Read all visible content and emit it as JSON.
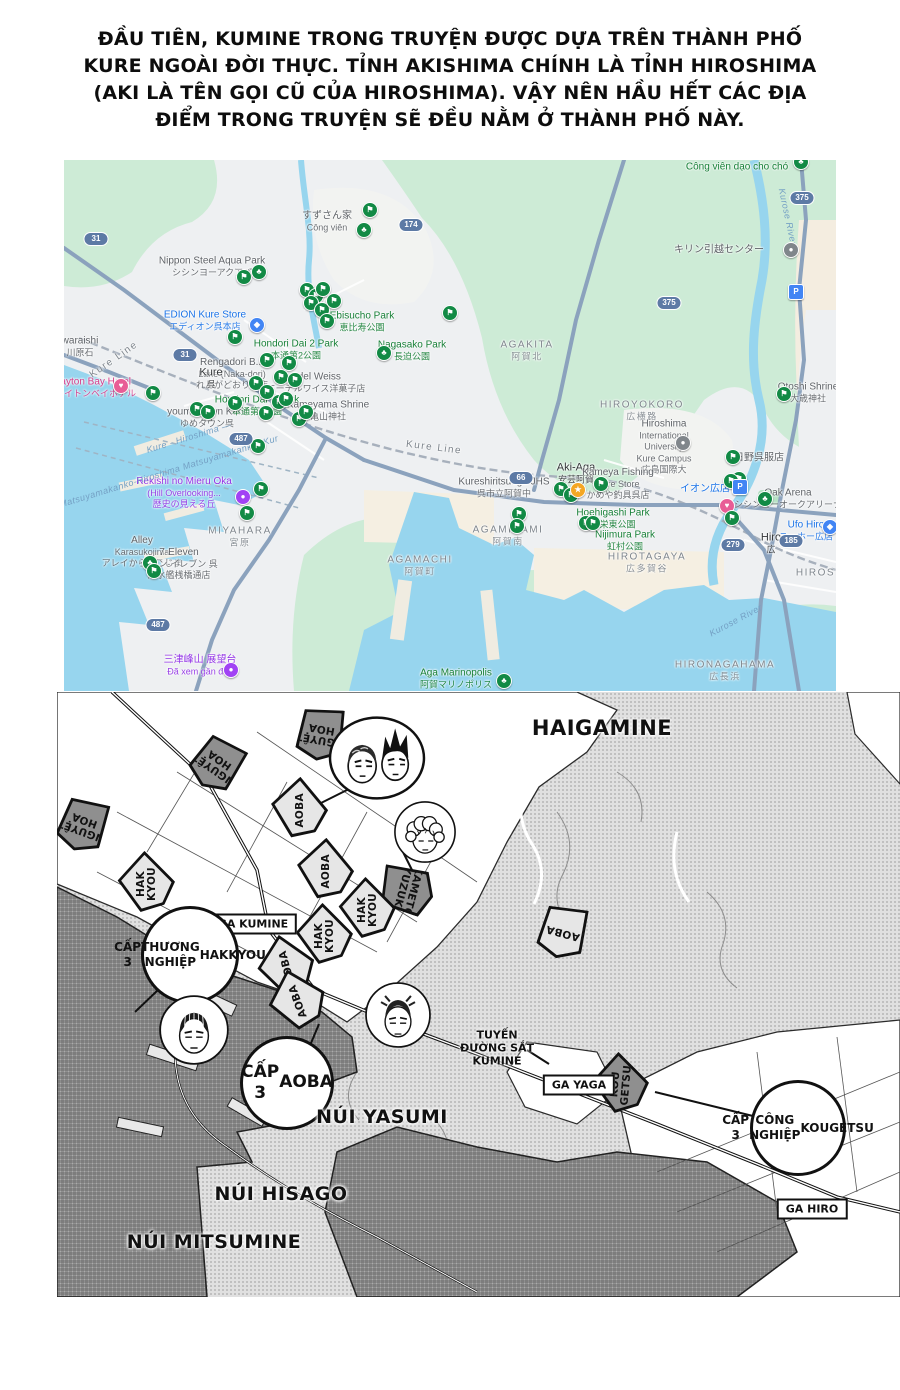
{
  "intro": {
    "lines": [
      "ĐẦU TIÊN, KUMINE TRONG TRUYỆN ĐƯỢC DỰA TRÊN THÀNH PHỐ",
      "KURE NGOÀI ĐỜI THỰC. TỈNH AKISHIMA CHÍNH LÀ TỈNH HIROSHIMA",
      "(AKI LÀ TÊN GỌI CŨ CỦA HIROSHIMA). VẬY NÊN HẦU HẾT CÁC ĐỊA",
      "ĐIỂM TRONG TRUYỆN SẼ ĐỀU NẰM Ở THÀNH PHỐ NÀY."
    ]
  },
  "gmap": {
    "palette": {
      "gray": "#5f6368",
      "green": "#188038",
      "blue": "#1a73e8",
      "purple": "#9334e6",
      "pink": "#d63b8a",
      "dark": "#333639",
      "area": "#7f868d",
      "water": "#74a0c4"
    },
    "marker_palette": {
      "f": "#128a45",
      "t": "#128a45",
      "s": "#f4a723",
      "h": "#e85d96",
      "b": "#4285f4",
      "p": "#4285f4",
      "v": "#a142f4",
      "g": "#80868b"
    },
    "labels": [
      {
        "l": [
          "すずさん家",
          "Công viên"
        ],
        "x": 263,
        "y": 62,
        "c": "gray"
      },
      {
        "l": [
          "Nippon Steel Aqua Park",
          "シシンヨーアクアパ"
        ],
        "x": 148,
        "y": 107,
        "c": "gray"
      },
      {
        "l": [
          "EDION Kure Store",
          "エディオン呉本店"
        ],
        "x": 141,
        "y": 161,
        "c": "blue"
      },
      {
        "l": [
          "Ebisucho Park",
          "恵比寿公園"
        ],
        "x": 298,
        "y": 162,
        "c": "green"
      },
      {
        "l": [
          "Nagasako Park",
          "長迫公園"
        ],
        "x": 348,
        "y": 191,
        "c": "green"
      },
      {
        "l": [
          "Hondori Dai 2 Park",
          "本通第2公園"
        ],
        "x": 232,
        "y": 190,
        "c": "green"
      },
      {
        "l": [
          "Rengadori B...",
          "Lane (Naka-dori)",
          "れんがどおり…店"
        ],
        "x": 168,
        "y": 214,
        "c": "gray"
      },
      {
        "l": [
          "Edel Weiss",
          "エーデルワイス洋菓子店"
        ],
        "x": 252,
        "y": 223,
        "c": "gray"
      },
      {
        "l": [
          "Kure",
          "呉"
        ],
        "x": 147,
        "y": 219,
        "c": "dark"
      },
      {
        "l": [
          "Clayton Bay Hotel",
          "クレイトンベイホテル"
        ],
        "x": 27,
        "y": 228,
        "c": "pink"
      },
      {
        "l": [
          "youme Town Kure",
          "ゆめタウン呉"
        ],
        "x": 143,
        "y": 258,
        "c": "gray"
      },
      {
        "l": [
          "Hondori Dai 3 Park",
          "本通第3公園"
        ],
        "x": 193,
        "y": 246,
        "c": "green"
      },
      {
        "l": [
          "Kameyama Shrine",
          "亀山神社"
        ],
        "x": 264,
        "y": 251,
        "c": "gray"
      },
      {
        "l": [
          "Rekishi no Mieru Oka",
          "(Hill Overlooking...",
          "歴史の見える丘"
        ],
        "x": 120,
        "y": 333,
        "c": "purple"
      },
      {
        "l": [
          "MIYAHARA",
          "宮原"
        ],
        "x": 176,
        "y": 377,
        "c": "area"
      },
      {
        "l": [
          "Alley",
          "Karasukojima",
          "アレイからすこじま"
        ],
        "x": 78,
        "y": 392,
        "c": "gray"
      },
      {
        "l": [
          "7-Eleven",
          "セブン-イレブン 呉",
          "潜水艦桟橋通店"
        ],
        "x": 115,
        "y": 404,
        "c": "gray"
      },
      {
        "l": [
          "AGAMACHI",
          "阿賀町"
        ],
        "x": 356,
        "y": 406,
        "c": "area"
      },
      {
        "l": [
          "三津峰山 展望台",
          "Đã xem gần đây"
        ],
        "x": 136,
        "y": 506,
        "c": "purple"
      },
      {
        "l": [
          "Aga Marinopolis",
          "阿賀マリノポリス"
        ],
        "x": 392,
        "y": 519,
        "c": "green"
      },
      {
        "l": [
          "AGAKITA",
          "阿賀北"
        ],
        "x": 463,
        "y": 191,
        "c": "area"
      },
      {
        "l": [
          "キリン引越センター"
        ],
        "x": 655,
        "y": 90,
        "c": "gray"
      },
      {
        "l": [
          "Công viên dạo cho chó"
        ],
        "x": 673,
        "y": 7,
        "c": "green"
      },
      {
        "l": [
          "Otoshi Shrine",
          "大歳神社"
        ],
        "x": 744,
        "y": 233,
        "c": "gray"
      },
      {
        "l": [
          "HIROYOKORO",
          "広横路"
        ],
        "x": 578,
        "y": 251,
        "c": "area"
      },
      {
        "l": [
          "Hiroshima",
          "International",
          "University",
          "Kure Campus",
          "広島国際大"
        ],
        "x": 600,
        "y": 287,
        "c": "gray"
      },
      {
        "l": [
          "日野呉服店"
        ],
        "x": 695,
        "y": 298,
        "c": "gray"
      },
      {
        "l": [
          "Aki-Aga",
          "安芸阿賀"
        ],
        "x": 512,
        "y": 314,
        "c": "dark"
      },
      {
        "l": [
          "Kameya Fishing",
          "Kure Store",
          "かめや釣具呉店"
        ],
        "x": 554,
        "y": 324,
        "c": "gray"
      },
      {
        "l": [
          "Kureshiritsuaga JHS",
          "呉市立阿賀中"
        ],
        "x": 440,
        "y": 328,
        "c": "gray"
      },
      {
        "l": [
          "イオン広店"
        ],
        "x": 641,
        "y": 329,
        "c": "blue"
      },
      {
        "l": [
          "Oak Arena",
          "シシンヨーオークアリーナ"
        ],
        "x": 724,
        "y": 339,
        "c": "gray"
      },
      {
        "l": [
          "Hoehigashi Park",
          "宝栄東公園"
        ],
        "x": 549,
        "y": 359,
        "c": "green"
      },
      {
        "l": [
          "Nijimura Park",
          "虹村公園"
        ],
        "x": 561,
        "y": 381,
        "c": "green"
      },
      {
        "l": [
          "AGAMINAMI",
          "阿賀南"
        ],
        "x": 444,
        "y": 376,
        "c": "area"
      },
      {
        "l": [
          "HIROTAGAYA",
          "広多賀谷"
        ],
        "x": 583,
        "y": 403,
        "c": "area"
      },
      {
        "l": [
          "HIRONAGAHAMA",
          "広長浜"
        ],
        "x": 661,
        "y": 511,
        "c": "area"
      },
      {
        "l": [
          "Ufo Hiro",
          "ユーホー広店"
        ],
        "x": 742,
        "y": 371,
        "c": "blue"
      },
      {
        "l": [
          "Hiro",
          "広"
        ],
        "x": 707,
        "y": 384,
        "c": "dark"
      },
      {
        "l": [
          "waraishi",
          "川原石"
        ],
        "x": 16,
        "y": 187,
        "c": "gray"
      },
      {
        "l": [
          "HIROSHI"
        ],
        "x": 758,
        "y": 413,
        "c": "area"
      },
      {
        "l": [
          "Kure Line"
        ],
        "x": 370,
        "y": 288,
        "c": "area",
        "rot": 7
      },
      {
        "l": [
          "Kure Line"
        ],
        "x": 50,
        "y": 200,
        "c": "area",
        "rot": -35
      },
      {
        "l": [
          "Kurose River"
        ],
        "x": 723,
        "y": 57,
        "c": "water",
        "rot": 78
      },
      {
        "l": [
          "Kurose River"
        ],
        "x": 672,
        "y": 461,
        "c": "water",
        "rot": -28
      },
      {
        "l": [
          "Kure - Hiroshima —"
        ],
        "x": 125,
        "y": 278,
        "c": "water",
        "rot": -17
      },
      {
        "l": [
          "Matsuyamakanko-Hiroshima Matsuyamakanko- Kur"
        ],
        "x": 105,
        "y": 312,
        "c": "water",
        "rot": -17
      }
    ],
    "markers": [
      {
        "x": 306,
        "y": 50,
        "t": "f"
      },
      {
        "x": 300,
        "y": 70,
        "t": "t"
      },
      {
        "x": 180,
        "y": 117,
        "t": "f"
      },
      {
        "x": 195,
        "y": 112,
        "t": "t"
      },
      {
        "x": 243,
        "y": 130,
        "t": "f"
      },
      {
        "x": 252,
        "y": 136,
        "t": "f"
      },
      {
        "x": 259,
        "y": 129,
        "t": "f"
      },
      {
        "x": 247,
        "y": 143,
        "t": "f"
      },
      {
        "x": 258,
        "y": 150,
        "t": "f"
      },
      {
        "x": 263,
        "y": 161,
        "t": "f"
      },
      {
        "x": 270,
        "y": 141,
        "t": "f"
      },
      {
        "x": 193,
        "y": 165,
        "t": "b"
      },
      {
        "x": 171,
        "y": 177,
        "t": "f"
      },
      {
        "x": 320,
        "y": 193,
        "t": "t"
      },
      {
        "x": 386,
        "y": 153,
        "t": "f"
      },
      {
        "x": 203,
        "y": 200,
        "t": "f"
      },
      {
        "x": 225,
        "y": 203,
        "t": "f"
      },
      {
        "x": 217,
        "y": 217,
        "t": "f"
      },
      {
        "x": 231,
        "y": 220,
        "t": "f"
      },
      {
        "x": 192,
        "y": 223,
        "t": "f"
      },
      {
        "x": 203,
        "y": 232,
        "t": "f"
      },
      {
        "x": 215,
        "y": 242,
        "t": "f"
      },
      {
        "x": 222,
        "y": 239,
        "t": "f"
      },
      {
        "x": 202,
        "y": 253,
        "t": "f"
      },
      {
        "x": 235,
        "y": 259,
        "t": "f"
      },
      {
        "x": 194,
        "y": 286,
        "t": "f"
      },
      {
        "x": 89,
        "y": 233,
        "t": "f"
      },
      {
        "x": 57,
        "y": 226,
        "t": "h"
      },
      {
        "x": 133,
        "y": 249,
        "t": "f"
      },
      {
        "x": 144,
        "y": 252,
        "t": "f"
      },
      {
        "x": 171,
        "y": 243,
        "t": "f"
      },
      {
        "x": 242,
        "y": 252,
        "t": "f"
      },
      {
        "x": 197,
        "y": 329,
        "t": "f"
      },
      {
        "x": 179,
        "y": 337,
        "t": "v"
      },
      {
        "x": 183,
        "y": 353,
        "t": "f"
      },
      {
        "x": 86,
        "y": 403,
        "t": "t"
      },
      {
        "x": 90,
        "y": 411,
        "t": "f"
      },
      {
        "x": 167,
        "y": 510,
        "t": "v"
      },
      {
        "x": 440,
        "y": 521,
        "t": "t"
      },
      {
        "x": 455,
        "y": 354,
        "t": "f"
      },
      {
        "x": 453,
        "y": 366,
        "t": "f"
      },
      {
        "x": 497,
        "y": 329,
        "t": "f"
      },
      {
        "x": 507,
        "y": 335,
        "t": "f"
      },
      {
        "x": 514,
        "y": 330,
        "t": "s"
      },
      {
        "x": 537,
        "y": 324,
        "t": "f"
      },
      {
        "x": 522,
        "y": 363,
        "t": "f"
      },
      {
        "x": 529,
        "y": 363,
        "t": "f"
      },
      {
        "x": 619,
        "y": 283,
        "t": "g"
      },
      {
        "x": 669,
        "y": 297,
        "t": "f"
      },
      {
        "x": 675,
        "y": 319,
        "t": "f"
      },
      {
        "x": 667,
        "y": 321,
        "t": "f"
      },
      {
        "x": 676,
        "y": 327,
        "t": "p"
      },
      {
        "x": 701,
        "y": 339,
        "t": "t"
      },
      {
        "x": 663,
        "y": 346,
        "t": "h"
      },
      {
        "x": 668,
        "y": 358,
        "t": "f"
      },
      {
        "x": 720,
        "y": 234,
        "t": "f"
      },
      {
        "x": 727,
        "y": 90,
        "t": "g"
      },
      {
        "x": 732,
        "y": 132,
        "t": "p"
      },
      {
        "x": 766,
        "y": 367,
        "t": "b"
      },
      {
        "x": 737,
        "y": 2,
        "t": "t"
      }
    ],
    "shields": [
      {
        "n": "31",
        "x": 32,
        "y": 79
      },
      {
        "n": "31",
        "x": 121,
        "y": 195
      },
      {
        "n": "174",
        "x": 347,
        "y": 65
      },
      {
        "n": "375",
        "x": 738,
        "y": 38
      },
      {
        "n": "375",
        "x": 605,
        "y": 143
      },
      {
        "n": "487",
        "x": 177,
        "y": 279
      },
      {
        "n": "487",
        "x": 94,
        "y": 465
      },
      {
        "n": "66",
        "x": 457,
        "y": 318
      },
      {
        "n": "185",
        "x": 727,
        "y": 381
      },
      {
        "n": "279",
        "x": 669,
        "y": 385
      }
    ]
  },
  "manga": {
    "regions": [
      {
        "text": "HAIGAMINE",
        "x": 545,
        "y": 36,
        "fs": 21
      },
      {
        "text": "NÚI YASUMI",
        "x": 325,
        "y": 425,
        "fs": 19
      },
      {
        "text": "NÚI HISAGO",
        "x": 224,
        "y": 502,
        "fs": 19
      },
      {
        "text": "NÚI MITSUMINE",
        "x": 157,
        "y": 550,
        "fs": 19
      }
    ],
    "stations": [
      {
        "text": "GA KUMINE",
        "x": 196,
        "y": 232
      },
      {
        "text": "GA YAGA",
        "x": 522,
        "y": 393
      },
      {
        "text": "GA HIRO",
        "x": 755,
        "y": 517
      }
    ],
    "banners": [
      {
        "lines": [
          "NGUYỆT",
          "HOA"
        ],
        "x": 264,
        "y": 42,
        "rot": 10,
        "trot": 180,
        "dark": true
      },
      {
        "lines": [
          "NGUYỆT",
          "HOA"
        ],
        "x": 160,
        "y": 72,
        "rot": 35,
        "trot": 180,
        "dark": true
      },
      {
        "lines": [
          "NGUYỆT",
          "HOA"
        ],
        "x": 26,
        "y": 133,
        "rot": 20,
        "trot": 180,
        "dark": true
      },
      {
        "lines": [
          "AOBA"
        ],
        "x": 243,
        "y": 118,
        "rot": -35,
        "trot": -55,
        "dark": false
      },
      {
        "lines": [
          "AOBA"
        ],
        "x": 269,
        "y": 179,
        "rot": -35,
        "trot": -55,
        "dark": false
      },
      {
        "lines": [
          "HAK",
          "KYOU"
        ],
        "x": 90,
        "y": 192,
        "rot": -40,
        "trot": -50,
        "dark": false
      },
      {
        "lines": [
          "KAMETO",
          "YUZUKI"
        ],
        "x": 350,
        "y": 198,
        "rot": -75,
        "trot": 180,
        "dark": true
      },
      {
        "lines": [
          "HAK",
          "KYOU"
        ],
        "x": 311,
        "y": 218,
        "rot": -40,
        "trot": -50,
        "dark": false
      },
      {
        "lines": [
          "HAK",
          "KYOU"
        ],
        "x": 268,
        "y": 244,
        "rot": -40,
        "trot": -50,
        "dark": false
      },
      {
        "lines": [
          "AOBA"
        ],
        "x": 230,
        "y": 275,
        "rot": -50,
        "trot": -55,
        "dark": false
      },
      {
        "lines": [
          "AOBA"
        ],
        "x": 241,
        "y": 309,
        "rot": -55,
        "trot": -55,
        "dark": false
      },
      {
        "lines": [
          "AOBA"
        ],
        "x": 506,
        "y": 240,
        "rot": 15,
        "trot": 180,
        "dark": false
      },
      {
        "lines": [
          "KOU",
          "GETSU"
        ],
        "x": 564,
        "y": 393,
        "rot": -40,
        "trot": -45,
        "dark": true
      }
    ],
    "circles": [
      {
        "lines": [
          "CẤP 3",
          "THƯƠNG NGHIỆP",
          "HAKKYOU"
        ],
        "x": 133,
        "y": 263,
        "r": 46,
        "fs": 12
      },
      {
        "lines": [
          "CẤP 3",
          "AOBA"
        ],
        "x": 230,
        "y": 391,
        "r": 44,
        "fs": 17
      },
      {
        "lines": [
          "CẤP 3",
          "CÔNG NGHIỆP",
          "KOUGETSU"
        ],
        "x": 741,
        "y": 436,
        "r": 45,
        "fs": 12
      }
    ],
    "rail_label": {
      "lines": [
        "TUYẾN",
        "ĐƯỜNG SẮT",
        "KUMINE"
      ],
      "x": 440,
      "y": 356
    },
    "faces": [
      {
        "type": "pair",
        "x": 320,
        "y": 66,
        "r": 43
      },
      {
        "type": "curly",
        "x": 368,
        "y": 140,
        "r": 32
      },
      {
        "type": "rows",
        "x": 137,
        "y": 338,
        "r": 36
      },
      {
        "type": "spiky",
        "x": 341,
        "y": 323,
        "r": 34
      }
    ]
  }
}
